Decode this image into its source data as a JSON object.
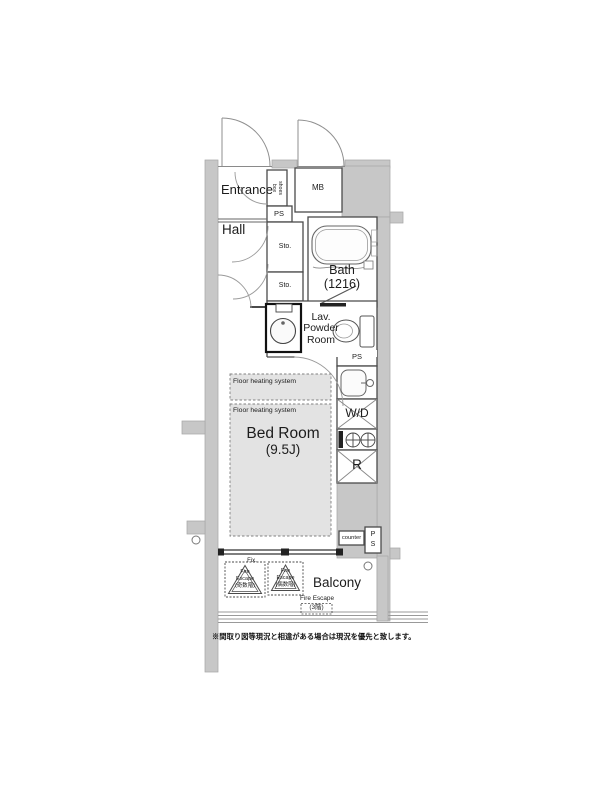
{
  "plan": {
    "rooms": {
      "entrance": "Entrance",
      "hall": "Hall",
      "bath": "Bath",
      "bath_size": "(1216)",
      "lav_line1": "Lav.",
      "lav_line2": "Powder",
      "lav_line3": "Room",
      "bedroom": "Bed Room",
      "bedroom_size": "(9.5J)",
      "balcony": "Balcony"
    },
    "fixtures": {
      "mb": "MB",
      "shoes_box_word1": "shoes",
      "shoes_box_word2": "box",
      "ps_top": "PS",
      "sto_upper": "Sto.",
      "sto_lower": "Sto.",
      "ps_mid": "PS",
      "washer_dryer": "W/D",
      "refrigerator": "R",
      "counter": "counter",
      "ps_bottom_p": "P",
      "ps_bottom_s": "S",
      "floor_heating_upper": "Floor heating system",
      "floor_heating_lower": "Floor heating system"
    },
    "balcony_items": {
      "fix_window": "Fix.",
      "fire_escape_odd_1": "Fire",
      "fire_escape_odd_2": "Escape",
      "fire_escape_odd_3": "(奇数階)",
      "fire_escape_even_1": "Fire",
      "fire_escape_even_2": "Escape",
      "fire_escape_even_3": "(偶数階)",
      "fire_escape_3f_1": "Fire Escape",
      "fire_escape_3f_2": "(3階)"
    },
    "note": "※間取り図等現況と相違がある場合は現況を優先と致します。",
    "colors": {
      "wall": "#c7c7c7",
      "wall_edge": "#a8a8a8",
      "line": "#4a4a4a",
      "floor_heating_fill": "#e3e3e3",
      "text": "#1c1c1c"
    }
  }
}
